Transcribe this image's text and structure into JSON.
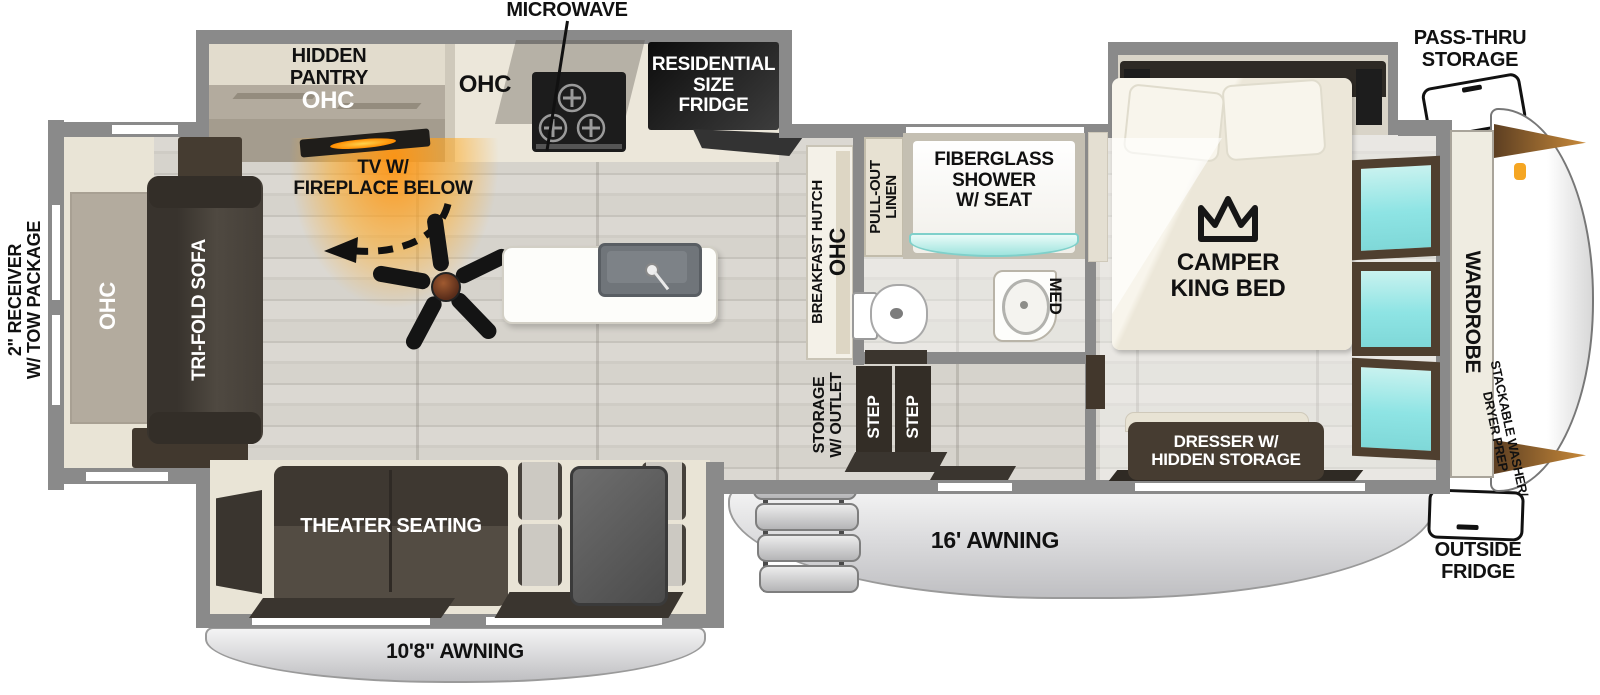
{
  "title": "Fifth wheel travel trailer floorplan",
  "colors": {
    "wall_gray": "#8a8a8a",
    "window_glass": "#8ee4e4",
    "fireplace_glow": "#ffa726",
    "dark_furniture": "#453d34",
    "awning_gray": "#d9d9db",
    "floor_wood": "#d6d3cc",
    "accent_handle_orange": "#f5a623"
  },
  "exterior": {
    "receiver": "2\" RECEIVER\nW/ TOW PACKAGE",
    "pass_thru": "PASS-THRU\nSTORAGE",
    "outside_fridge": "OUTSIDE\nFRIDGE",
    "awning_main": "16' AWNING",
    "awning_rear": "10'8\" AWNING"
  },
  "living": {
    "ohc": "OHC",
    "sofa": "TRI-FOLD SOFA",
    "tv": "TV W/\nFIREPLACE BELOW",
    "theater": "THEATER SEATING"
  },
  "kitchen": {
    "microwave": "MICROWAVE",
    "hidden_pantry": "HIDDEN\nPANTRY",
    "pantry_ohc": "OHC",
    "ohc": "OHC",
    "fridge": "RESIDENTIAL\nSIZE\nFRIDGE",
    "hutch": "BREAKFAST HUTCH",
    "hutch_ohc": "OHC"
  },
  "bath": {
    "shower": "FIBERGLASS\nSHOWER\nW/ SEAT",
    "linen": "PULL-OUT\nLINEN",
    "med": "MED",
    "storage_outlet": "STORAGE\nW/ OUTLET",
    "step1": "STEP",
    "step2": "STEP"
  },
  "bedroom": {
    "bed": "CAMPER\nKING BED",
    "dresser": "DRESSER W/\nHIDDEN STORAGE",
    "wardrobe": "WARDROBE",
    "washer_prep": "STACKABLE WASHER/\nDRYER PREP"
  }
}
